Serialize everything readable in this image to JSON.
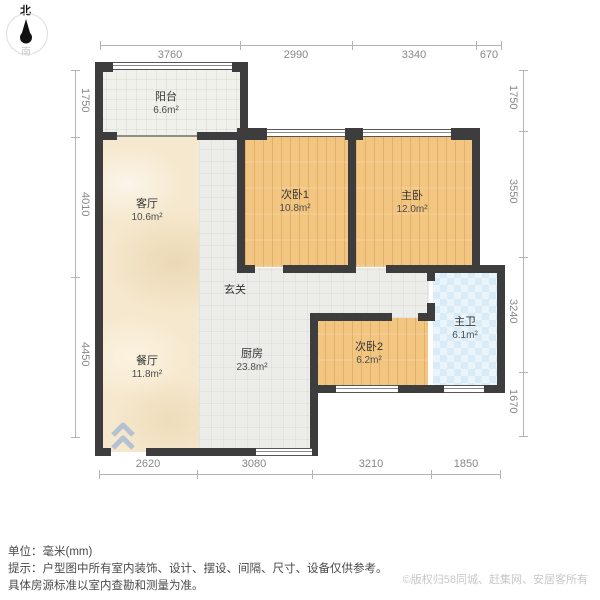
{
  "compass": {
    "north": "北",
    "south": "南"
  },
  "rooms": {
    "balcony": {
      "name": "阳台",
      "area": "6.6m²"
    },
    "living": {
      "name": "客厅",
      "area": "10.6m²"
    },
    "bedroom1": {
      "name": "次卧1",
      "area": "10.8m²"
    },
    "master": {
      "name": "主卧",
      "area": "12.0m²"
    },
    "foyer": {
      "name": "玄关"
    },
    "dining": {
      "name": "餐厅",
      "area": "11.8m²"
    },
    "kitchen": {
      "name": "厨房",
      "area": "23.8m²"
    },
    "bedroom2": {
      "name": "次卧2",
      "area": "6.2m²"
    },
    "master_bath": {
      "name": "主卫",
      "area": "6.1m²"
    }
  },
  "dimensions": {
    "top": [
      "3760",
      "2990",
      "3340",
      "670"
    ],
    "bottom": [
      "2620",
      "3080",
      "3210",
      "1850"
    ],
    "left": [
      "1750",
      "4010",
      "4450"
    ],
    "right": [
      "1750",
      "3550",
      "3240",
      "1670"
    ]
  },
  "footer": {
    "unit": "单位：毫米(mm)",
    "tip_line1": "提示：户型图中所有室内装饰、设计、摆设、间隔、尺寸、设备仅供参考。",
    "tip_line2": "具体房源标准以室内查勘和测量为准。",
    "copyright": "©版权归58同城、赶集网、安居客所有"
  },
  "colors": {
    "wall": "#3d3d3d",
    "wood_floor": "#f2c580",
    "marble_floor": "#f6e8ce",
    "tile_floor": "#ecece8",
    "bath_tile": "#d8ebf6"
  }
}
